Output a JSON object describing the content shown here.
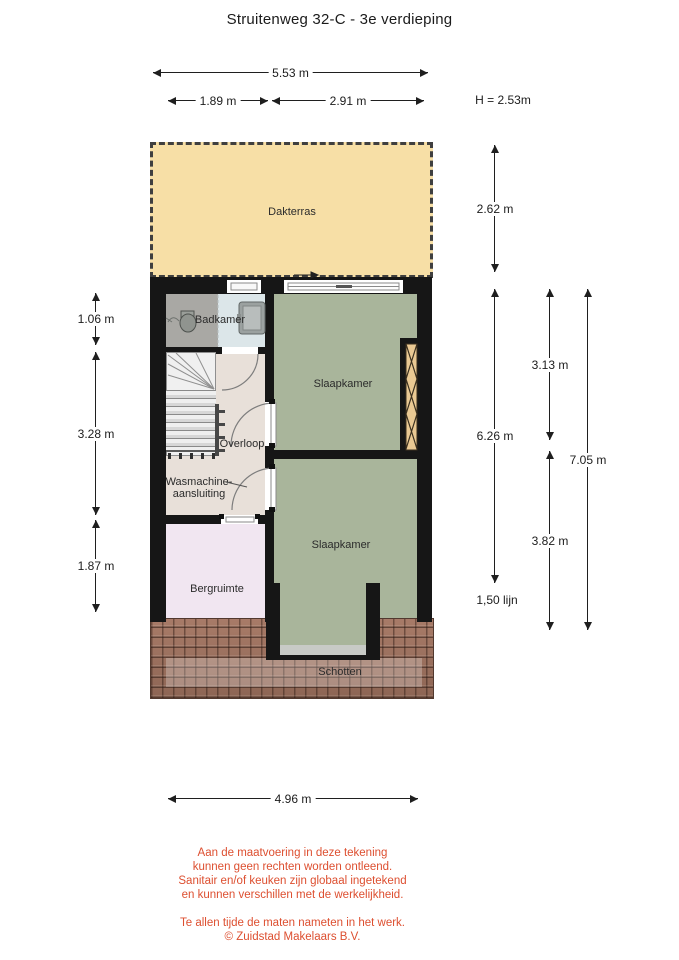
{
  "title": "Struitenweg 32-C - 3e verdieping",
  "height_note": "H = 2.53m",
  "rooms": {
    "dakterras": "Dakterras",
    "badkamer": "Badkamer",
    "slaapkamer_1": "Slaapkamer",
    "slaapkamer_2": "Slaapkamer",
    "overloop": "Overloop",
    "wasmachine_line1": "Wasmachine-",
    "wasmachine_line2": "aansluiting",
    "bergruimte": "Bergruimte",
    "schotten": "Schotten"
  },
  "dimensions": {
    "top_total": "5.53 m",
    "top_left": "1.89 m",
    "top_right": "2.91 m",
    "left_top": "1.06 m",
    "left_middle": "3.28 m",
    "left_bottom": "1.87 m",
    "right_terrace": "2.62 m",
    "right_interior": "6.26 m",
    "right_line_note": "1,50 lijn",
    "right_bed1": "3.13 m",
    "right_bed2": "3.82 m",
    "right_total": "7.05 m",
    "bottom_width": "4.96 m"
  },
  "disclaimer": {
    "lines": [
      "Aan de maatvoering in deze tekening",
      "kunnen geen rechten worden ontleend.",
      "Sanitair en/of keuken zijn globaal ingetekend",
      "en kunnen verschillen met de werkelijkheid.",
      "Te allen tijde de maten nameten in het werk.",
      "© Zuidstad Makelaars B.V."
    ]
  },
  "icons": {
    "sliding_door_arrow": "right-arrow",
    "dimension_arrow": "double-headed-arrow"
  },
  "colors": {
    "terrace": "#f7dfa6",
    "bedroom_floor": "#a9b59b",
    "landing_floor": "#e8e0d9",
    "storage_floor": "#f1e6f1",
    "bathroom_floor": "#a9a8a4",
    "bathroom_wet_floor": "#dce6e9",
    "roof_tiles": "#9b7261",
    "wall": "#161616",
    "ladder_wood": "#e9c globally"
  }
}
